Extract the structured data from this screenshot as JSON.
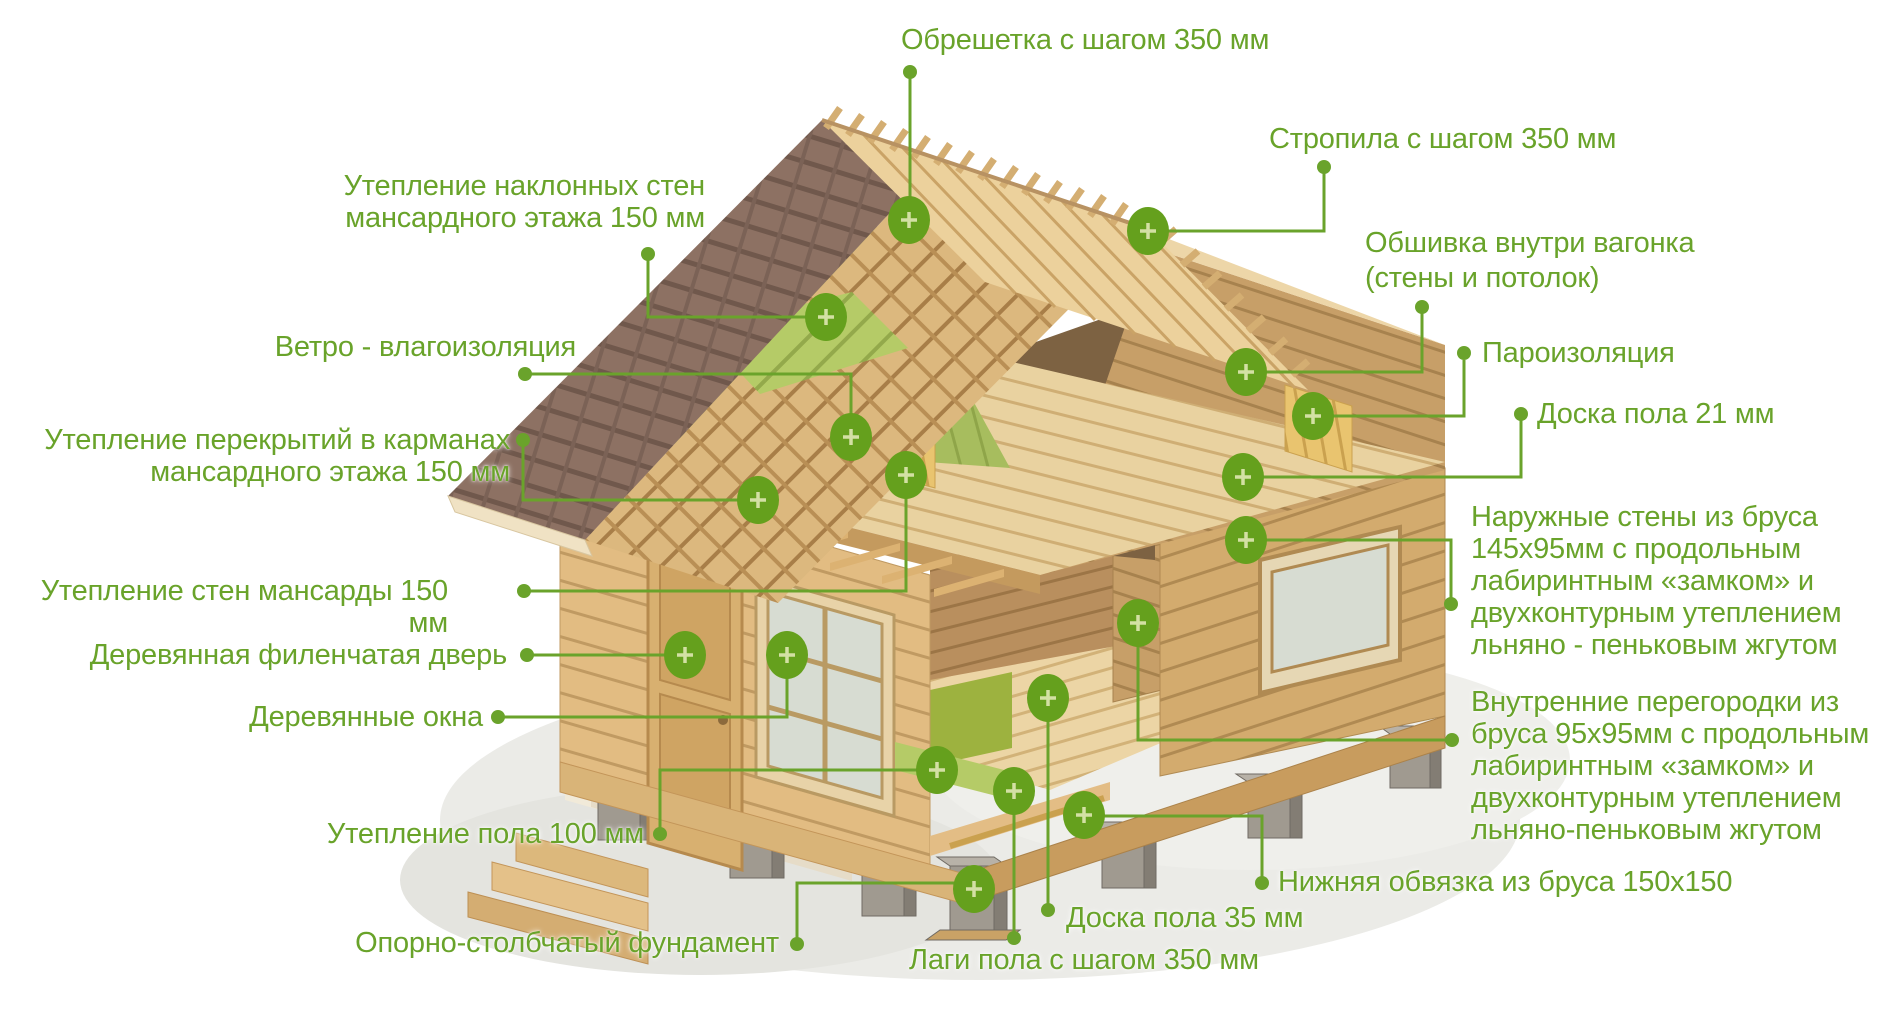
{
  "figure": {
    "type": "house-construction-cutaway-infographic",
    "language": "ru",
    "background": "#ffffff",
    "accent_green": "#69a32a",
    "marker_green": "#65a01d",
    "marker_plus_color": "#d3e0a4",
    "marker_symbol": "+"
  },
  "labels": {
    "obreshetka": {
      "text": "Обрешетка с шагом 350 мм"
    },
    "stropila": {
      "text": "Стропила с шагом 350 мм"
    },
    "naklonnye": {
      "text": "Утепление наклонных стен\nмансардного этажа 150 мм"
    },
    "vetro": {
      "text": "Ветро - влагоизоляция"
    },
    "perekrytiya": {
      "text": "Утепление перекрытий в карманах\nмансардного этажа 150 мм"
    },
    "sten_mansardy": {
      "text": "Утепление стен мансарды 150 мм"
    },
    "dver": {
      "text": "Деревянная филенчатая дверь"
    },
    "okna": {
      "text": "Деревянные окна"
    },
    "pol100": {
      "text": "Утепление пола 100 мм"
    },
    "oporno": {
      "text": "Опорно-столбчатый фундамент"
    },
    "lagi": {
      "text": "Лаги пола с шагом 350 мм"
    },
    "doska35": {
      "text": "Доска пола 35 мм"
    },
    "obvyazka": {
      "text": "Нижняя обвязка из бруса 150х150"
    },
    "obshivka": {
      "text": "Обшивка внутри вагонка\n(стены и потолок)"
    },
    "paroizolyaciya": {
      "text": "Пароизоляция"
    },
    "doska21": {
      "text": "Доска пола 21 мм"
    },
    "naruzhnye": {
      "text": "Наружные стены из бруса\n145х95мм с продольным\nлабиринтным «замком» и\nдвухконтурным утеплением\nльняно - пеньковым жгутом"
    },
    "vnutrennie": {
      "text": "Внутренние перегородки из\nбруса 95х95мм с продольным\nлабиринтным «замком» и\nдвухконтурным утеплением\nльняно-пеньковым жгутом"
    }
  }
}
